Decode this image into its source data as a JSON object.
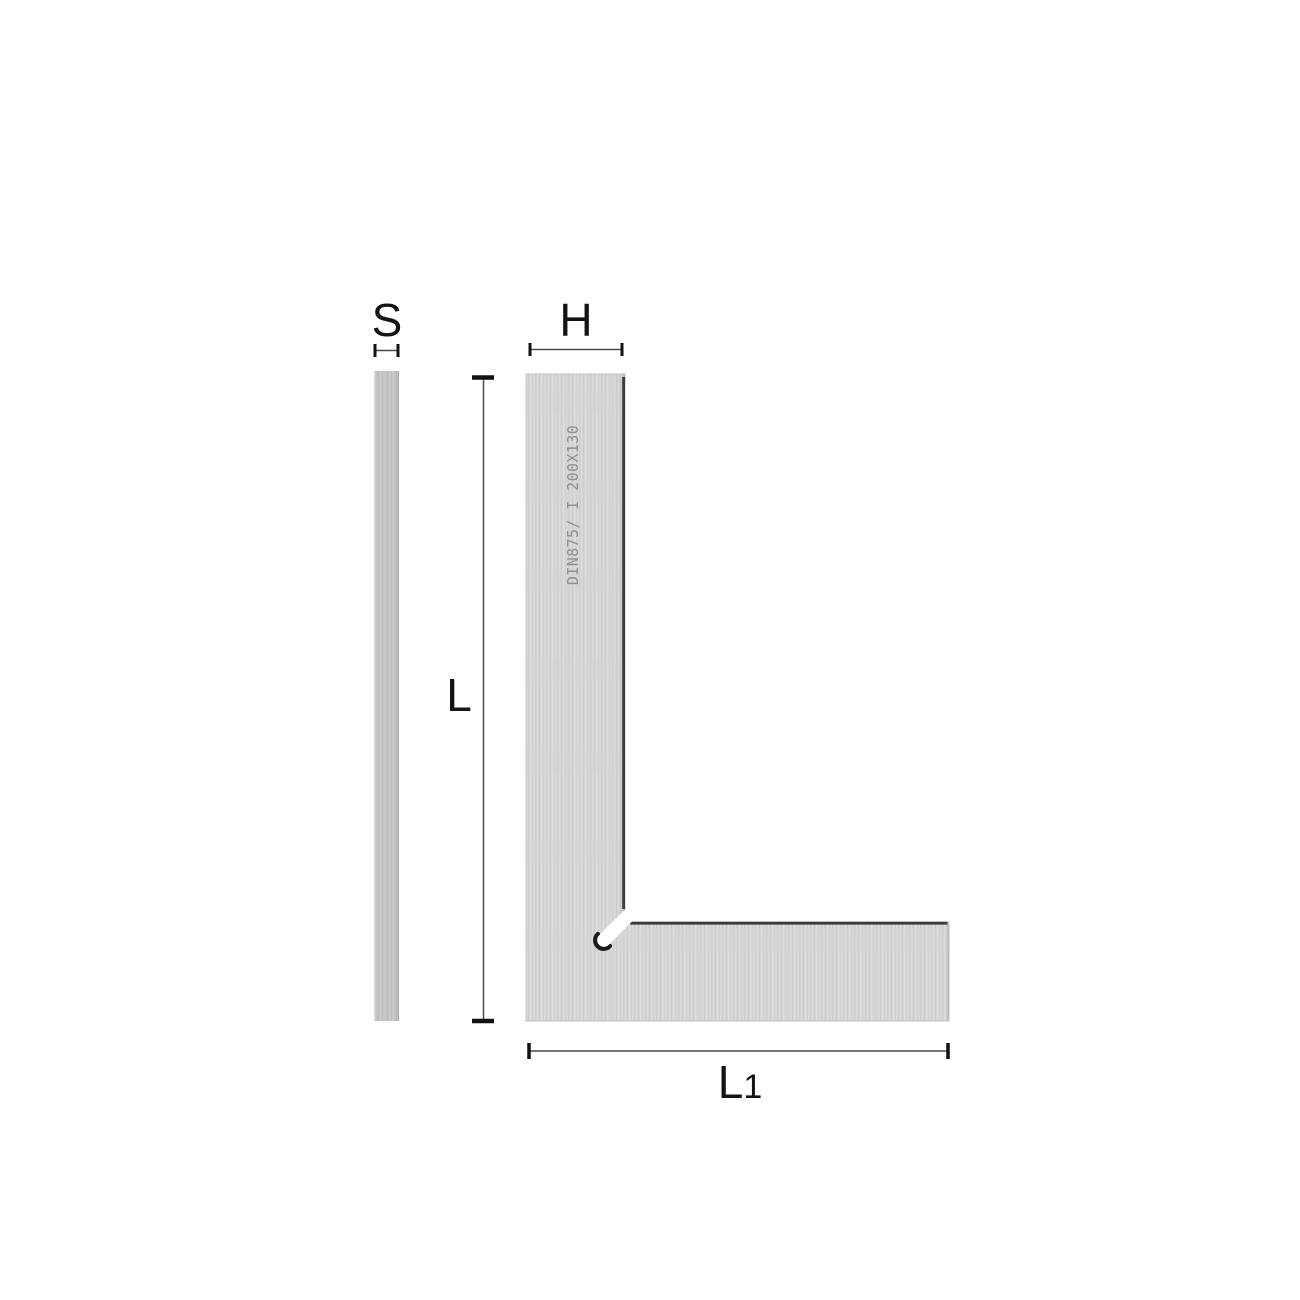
{
  "diagram": {
    "type": "technical-drawing",
    "subject": "flat machinist square (DIN 875), side profile and front view with dimension callouts",
    "dimension_labels": {
      "s": "S",
      "h": "H",
      "l": "L",
      "l1_main": "L",
      "l1_sub": "1"
    },
    "engraving": "DIN875/ I  200X130",
    "colors": {
      "background": "#ffffff",
      "metal_face": "#d6d6d6",
      "metal_side": "#c5c5c5",
      "edge_dark": "#3c3c3c",
      "dim_line": "#4a4a4a",
      "tick": "#111111",
      "label_text": "#141414",
      "engraving_text": "#8f8f8f",
      "relief_slot": "#ffffff",
      "relief_shadow": "#1a1a1a"
    }
  }
}
